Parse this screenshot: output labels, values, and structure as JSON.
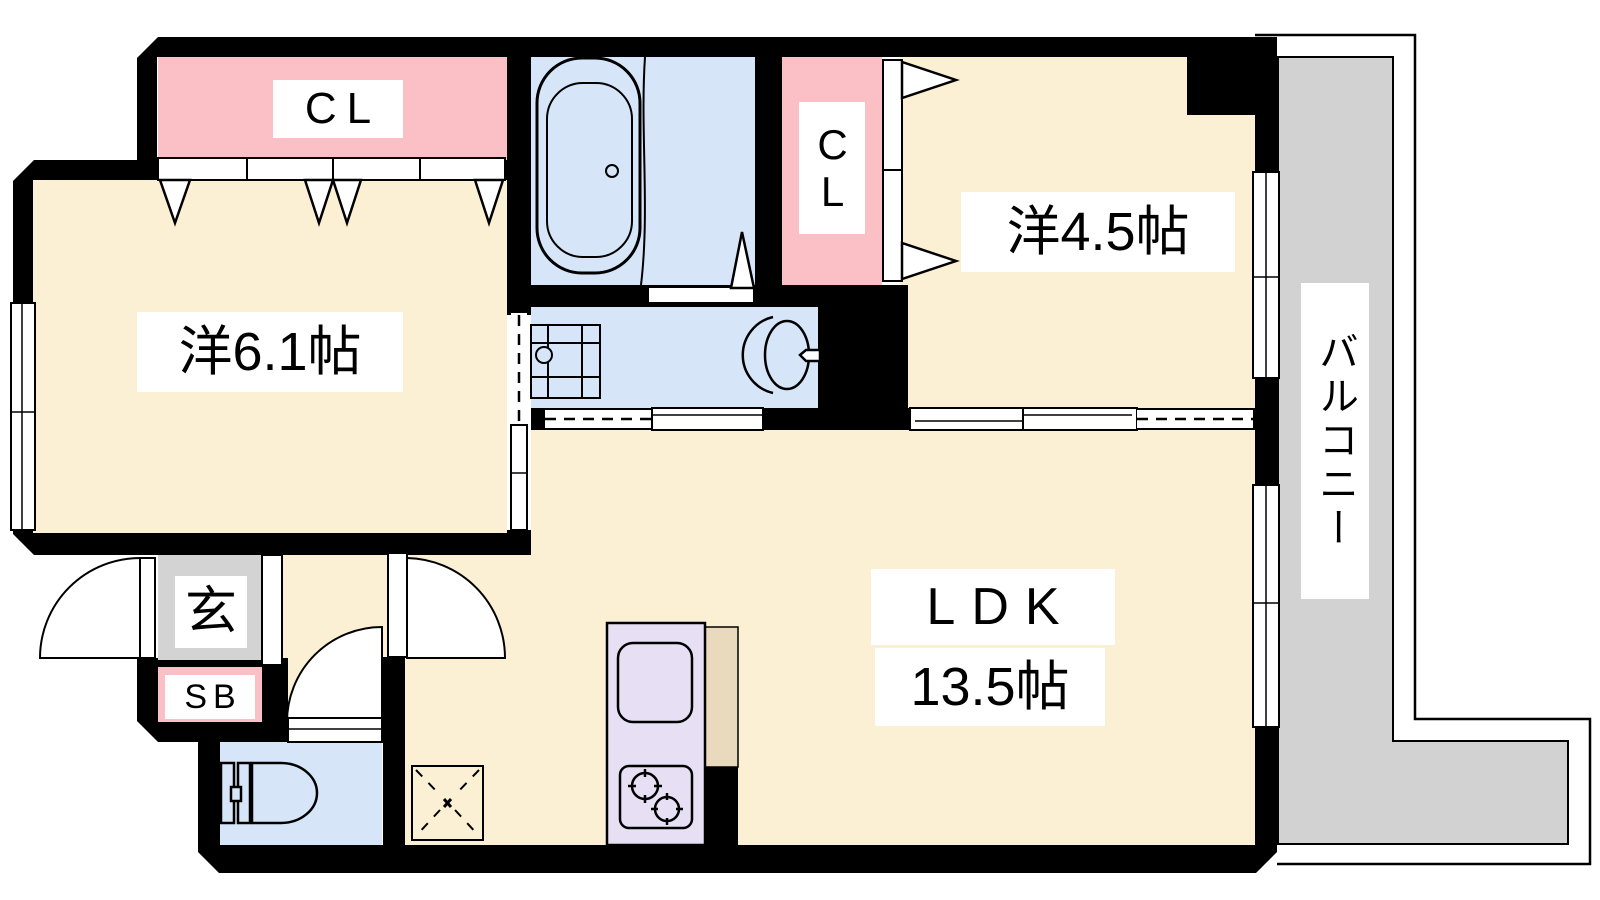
{
  "plan_type": "apartment-floorplan",
  "labels": {
    "closet_main": "CL",
    "closet_east": "CL",
    "room_west": "洋6.1帖",
    "room_east": "洋4.5帖",
    "ldk_line1": "LDK",
    "ldk_line2": "13.5帖",
    "balcony": "バルコニー",
    "entrance": "玄",
    "shoebox": "SB"
  },
  "colors": {
    "wall": "#000000",
    "room_floor": "#FBF0D3",
    "wet_area": "#D6E6F8",
    "closet_pink": "#FAC0C5",
    "entrance_gray": "#D3D3D3",
    "balcony_gray": "#D2D2D2",
    "kitchen_counter": "#E7DFF3",
    "counter_shadow": "#E9DABE",
    "line": "#000000",
    "background": "#FFFFFF"
  }
}
